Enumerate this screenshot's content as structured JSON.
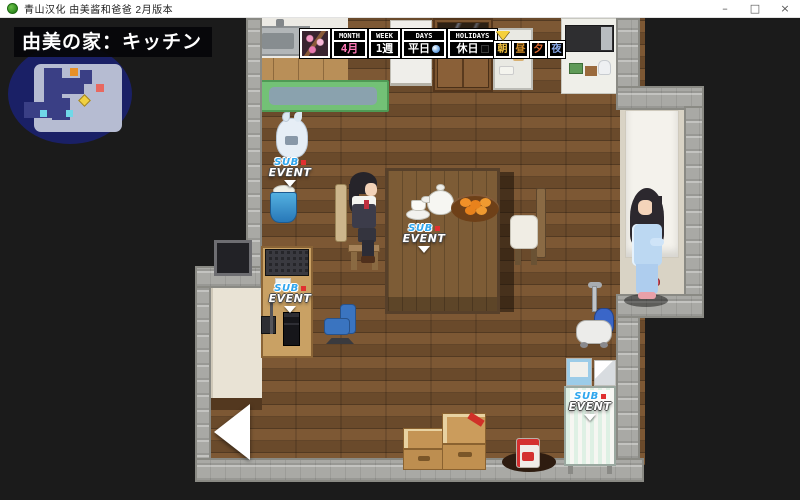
{
  "window": {
    "title": "青山汉化 由美酱和爸爸 2月版本",
    "minimize": "–",
    "maximize": "□",
    "close": "×"
  },
  "hud": {
    "location": "由美の家：キッチン",
    "calendar": {
      "month_label": "MONTH",
      "month_value": "4月",
      "week_label": "WEEK",
      "week_value": "1週",
      "days_label": "DAYS",
      "days_value": "平日",
      "holidays_label": "HOLIDAYS",
      "holidays_value": "休日",
      "time_slots": [
        "朝",
        "昼",
        "夕",
        "夜"
      ],
      "active_slot": "朝"
    }
  },
  "markers": {
    "sub": "SUB",
    "event": "EVENT"
  },
  "colors": {
    "sub_event_blue": "#2fa6ee",
    "event_dot_red": "#e03030",
    "month_pink": "#ff7ab8",
    "active_pointer_gold": "#f5d03c",
    "minimap_bg": "#1a2066",
    "player_marker_yellow": "#f0d040"
  }
}
